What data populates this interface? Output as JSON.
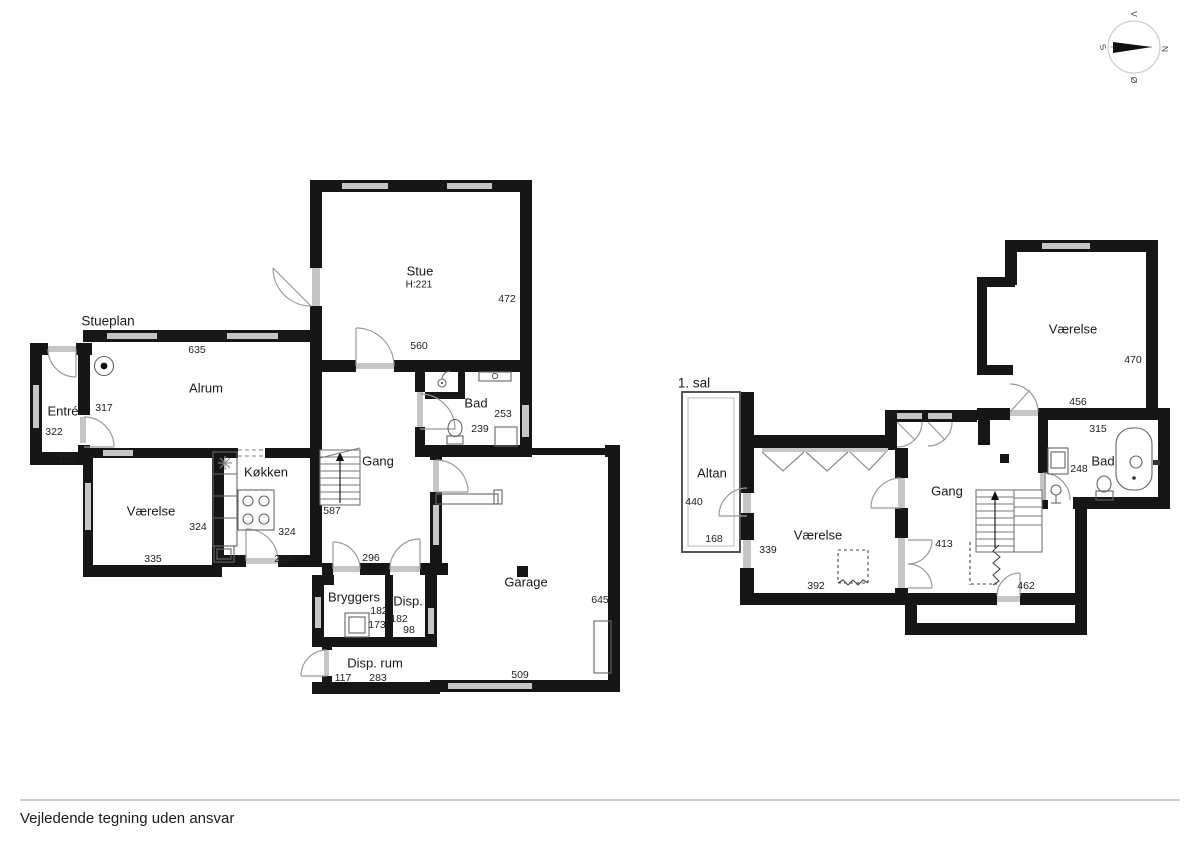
{
  "footer": {
    "disclaimer": "Vejledende tegning uden ansvar"
  },
  "compass": {
    "north": "N",
    "south": "S",
    "east": "Ø",
    "west": "V"
  },
  "ground_floor": {
    "plan_label": "Stueplan",
    "rooms": {
      "stue": {
        "name": "Stue",
        "ceiling_height": "H:221",
        "dims": {
          "right": "472",
          "bottom": "560"
        }
      },
      "alrum": {
        "name": "Alrum",
        "dims": {
          "top": "635"
        }
      },
      "entre": {
        "name": "Entré",
        "dims": {
          "door": "317",
          "left": "322",
          "bottom": "122"
        }
      },
      "bad": {
        "name": "Bad",
        "dims": {
          "right": "253",
          "bottom": "239"
        }
      },
      "gang": {
        "name": "Gang",
        "dims": {
          "stairs": "587",
          "bottom": "296"
        }
      },
      "vaerelse": {
        "name": "Værelse",
        "dims": {
          "right": "324",
          "bottom": "335"
        }
      },
      "kokken": {
        "name": "Køkken",
        "dims": {
          "right": "324",
          "bottom": "288"
        }
      },
      "bryggers": {
        "name": "Bryggers",
        "dims": {
          "width": "182",
          "height": "173"
        }
      },
      "disp": {
        "name": "Disp.",
        "dims": {
          "width": "182",
          "height": "98"
        }
      },
      "disp_rum": {
        "name": "Disp. rum",
        "dims": {
          "left": "117",
          "bottom": "283"
        }
      },
      "garage": {
        "name": "Garage",
        "dims": {
          "right": "645",
          "bottom": "509"
        }
      }
    }
  },
  "first_floor": {
    "plan_label": "1. sal",
    "rooms": {
      "altan": {
        "name": "Altan",
        "dims": {
          "left": "440",
          "bottom": "168"
        }
      },
      "vaerelse_sv": {
        "name": "Værelse",
        "dims": {
          "left": "339",
          "bottom": "392"
        }
      },
      "gang": {
        "name": "Gang",
        "dims": {
          "left": "413",
          "bottom": "462"
        }
      },
      "vaerelse_no": {
        "name": "Værelse",
        "dims": {
          "right": "470",
          "bottom": "456"
        }
      },
      "bad": {
        "name": "Bad",
        "dims": {
          "top": "315",
          "left": "248"
        }
      }
    }
  }
}
